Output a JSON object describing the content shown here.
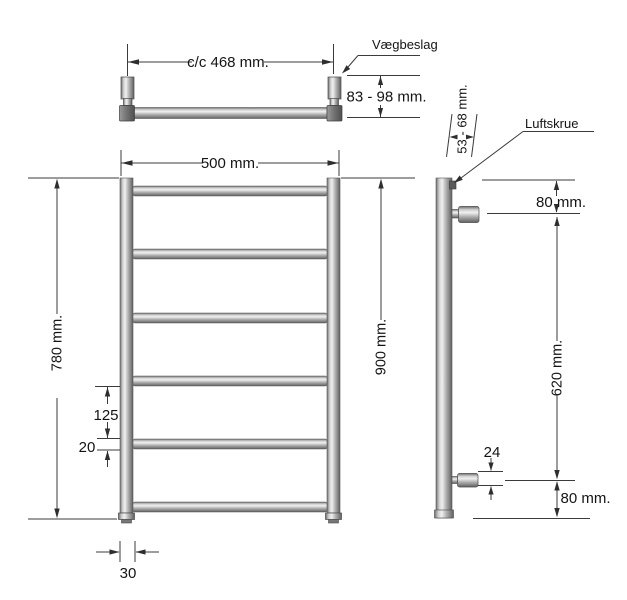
{
  "colors": {
    "background": "#ffffff",
    "dimension_line": "#3b3b3b",
    "text": "#141414",
    "metal_light": "#f0f0f0",
    "metal_mid": "#b3b3b3",
    "metal_dark": "#606060"
  },
  "top_view": {
    "center_distance_label": "c/c 468 mm.",
    "wall_bracket_label": "Vægbeslag",
    "wall_depth_range_label": "83 - 98 mm."
  },
  "front_view": {
    "width_label": "500 mm.",
    "height_label": "780 mm.",
    "install_height_label": "900 mm.",
    "rung_spacing_label": "125",
    "rung_diameter_label": "20",
    "tube_diameter_label": "30"
  },
  "side_view": {
    "wall_distance_label": "53 - 68 mm.",
    "air_screw_label": "Luftskrue",
    "top_offset_label": "80 mm.",
    "connection_span_label": "620 mm.",
    "valve_diameter_label": "24",
    "bottom_offset_label": "80 mm."
  }
}
